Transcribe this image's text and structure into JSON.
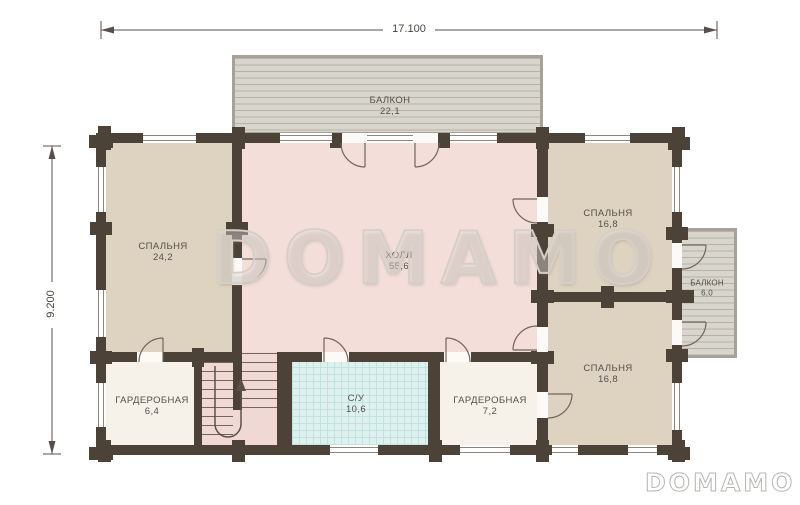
{
  "dimensions": {
    "width_label": "17.100",
    "height_label": "9.200"
  },
  "watermark": {
    "center": "DOMAMO",
    "corner": "DOMAMO"
  },
  "rooms": {
    "balcony_top": {
      "name": "БАЛКОН",
      "area": "22,1"
    },
    "bedroom_left": {
      "name": "СПАЛЬНЯ",
      "area": "24,2"
    },
    "hall": {
      "name": "ХОЛЛ",
      "area": "55,6"
    },
    "bedroom_top_right": {
      "name": "СПАЛЬНЯ",
      "area": "16,8"
    },
    "balcony_right": {
      "name": "БАЛКОН",
      "area": "6,0"
    },
    "bedroom_bottom_right": {
      "name": "СПАЛЬНЯ",
      "area": "16,8"
    },
    "wardrobe_left": {
      "name": "ГАРДЕРОБНАЯ",
      "area": "6,4"
    },
    "bathroom": {
      "name": "С/У",
      "area": "10,6"
    },
    "wardrobe_right": {
      "name": "ГАРДЕРОБНАЯ",
      "area": "7,2"
    }
  },
  "colors": {
    "wall": "#4c4237",
    "bedroom": "#ded2c1",
    "hall": "#f3ded9",
    "wardrobe": "#f6f1e9",
    "bathroom": "#dff1ee",
    "balcony": "#d8d5cc"
  }
}
